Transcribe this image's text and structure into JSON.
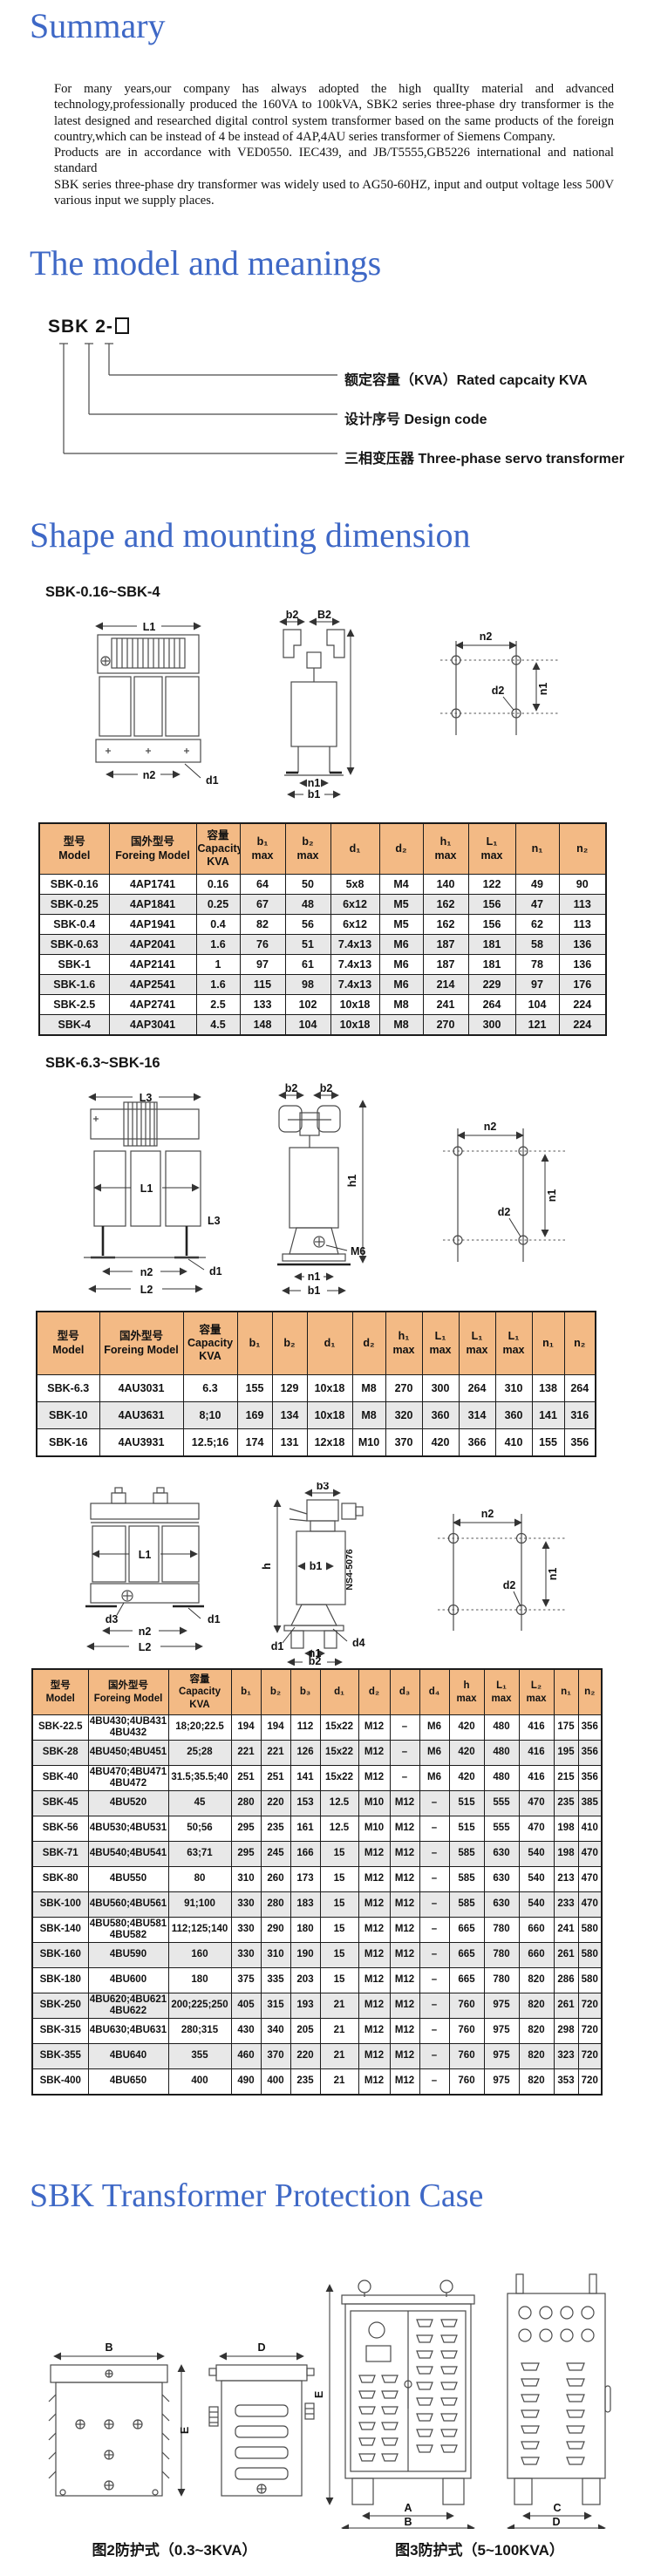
{
  "colors": {
    "heading_blue": "#3E68C6",
    "table_header_bg": "#F3BA85",
    "row_alt": "#E8E8E8"
  },
  "headings": {
    "summary": "Summary",
    "model": "The model and meanings",
    "shape": "Shape and mounting dimension",
    "protection": "SBK Transformer Protection Case"
  },
  "summary": {
    "p1": "For many years,our company has always adopted the high qualIty material and advanced technology,professionally produced the 160VA to 100kVA, SBK2 series three-phase dry transformer is the latest designed and researched digital control system transformer based on the same products of the foreign country,which can be instead of 4 be instead of 4AP,4AU series transformer of Siemens Company.",
    "p2": "Products are in accordance with VED0550. IEC439, and JB/T5555,GB5226 international and national standard",
    "p3": "SBK series three-phase dry transformer was widely used to AG50-60HZ, input and output voltage less 500V various input we supply places."
  },
  "model_diagram": {
    "code_prefix": "SBK",
    "code_mid": "2",
    "code_suffix": "-",
    "label_capacity": "额定容量（KVA）Rated capcaity KVA",
    "label_design": "设计序号 Design code",
    "label_phase": "三相变压器 Three-phase servo transformer"
  },
  "section1": {
    "label": "SBK-0.16~SBK-4",
    "header": [
      "型号\nModel",
      "国外型号\nForeing Model",
      "容量\nCapacity\nKVA",
      "b₁\nmax",
      "b₂\nmax",
      "d₁",
      "d₂",
      "h₁\nmax",
      "L₁\nmax",
      "n₁",
      "n₂"
    ],
    "rows": [
      [
        "SBK-0.16",
        "4AP1741",
        "0.16",
        "64",
        "50",
        "5x8",
        "M4",
        "140",
        "122",
        "49",
        "90"
      ],
      [
        "SBK-0.25",
        "4AP1841",
        "0.25",
        "67",
        "48",
        "6x12",
        "M5",
        "162",
        "156",
        "47",
        "113"
      ],
      [
        "SBK-0.4",
        "4AP1941",
        "0.4",
        "82",
        "56",
        "6x12",
        "M5",
        "162",
        "156",
        "62",
        "113"
      ],
      [
        "SBK-0.63",
        "4AP2041",
        "1.6",
        "76",
        "51",
        "7.4x13",
        "M6",
        "187",
        "181",
        "58",
        "136"
      ],
      [
        "SBK-1",
        "4AP2141",
        "1",
        "97",
        "61",
        "7.4x13",
        "M6",
        "187",
        "181",
        "78",
        "136"
      ],
      [
        "SBK-1.6",
        "4AP2541",
        "1.6",
        "115",
        "98",
        "7.4x13",
        "M6",
        "214",
        "229",
        "97",
        "176"
      ],
      [
        "SBK-2.5",
        "4AP2741",
        "2.5",
        "133",
        "102",
        "10x18",
        "M8",
        "241",
        "264",
        "104",
        "224"
      ],
      [
        "SBK-4",
        "4AP3041",
        "4.5",
        "148",
        "104",
        "10x18",
        "M8",
        "270",
        "300",
        "121",
        "224"
      ]
    ]
  },
  "section2": {
    "label": "SBK-6.3~SBK-16",
    "header": [
      "型号\nModel",
      "国外型号\nForeing Model",
      "容量\nCapacity\nKVA",
      "b₁",
      "b₂",
      "d₁",
      "d₂",
      "h₁\nmax",
      "L₁\nmax",
      "L₁\nmax",
      "L₁\nmax",
      "n₁",
      "n₂"
    ],
    "rows": [
      [
        "SBK-6.3",
        "4AU3031",
        "6.3",
        "155",
        "129",
        "10x18",
        "M8",
        "270",
        "300",
        "264",
        "310",
        "138",
        "264"
      ],
      [
        "SBK-10",
        "4AU3631",
        "8;10",
        "169",
        "134",
        "10x18",
        "M8",
        "320",
        "360",
        "314",
        "360",
        "141",
        "316"
      ],
      [
        "SBK-16",
        "4AU3931",
        "12.5;16",
        "174",
        "131",
        "12x18",
        "M10",
        "370",
        "420",
        "366",
        "410",
        "155",
        "356"
      ]
    ]
  },
  "section3": {
    "header": [
      "型号\nModel",
      "国外型号\nForeing Model",
      "容量\nCapacity\nKVA",
      "b₁",
      "b₂",
      "b₃",
      "d₁",
      "d₂",
      "d₃",
      "d₄",
      "h\nmax",
      "L₁\nmax",
      "L₂\nmax",
      "n₁",
      "n₂"
    ],
    "rows": [
      [
        "SBK-22.5",
        "4BU430;4UB431\n4BU432",
        "18;20;22.5",
        "194",
        "194",
        "112",
        "15x22",
        "M12",
        "–",
        "M6",
        "420",
        "480",
        "416",
        "175",
        "356"
      ],
      [
        "SBK-28",
        "4BU450;4BU451",
        "25;28",
        "221",
        "221",
        "126",
        "15x22",
        "M12",
        "–",
        "M6",
        "420",
        "480",
        "416",
        "195",
        "356"
      ],
      [
        "SBK-40",
        "4BU470;4BU471\n4BU472",
        "31.5;35.5;40",
        "251",
        "251",
        "141",
        "15x22",
        "M12",
        "–",
        "M6",
        "420",
        "480",
        "416",
        "215",
        "356"
      ],
      [
        "SBK-45",
        "4BU520",
        "45",
        "280",
        "220",
        "153",
        "12.5",
        "M10",
        "M12",
        "–",
        "515",
        "555",
        "470",
        "235",
        "385"
      ],
      [
        "SBK-56",
        "4BU530;4BU531",
        "50;56",
        "295",
        "235",
        "161",
        "12.5",
        "M10",
        "M12",
        "–",
        "515",
        "555",
        "470",
        "198",
        "410"
      ],
      [
        "SBK-71",
        "4BU540;4BU541",
        "63;71",
        "295",
        "245",
        "166",
        "15",
        "M12",
        "M12",
        "–",
        "585",
        "630",
        "540",
        "198",
        "470"
      ],
      [
        "SBK-80",
        "4BU550",
        "80",
        "310",
        "260",
        "173",
        "15",
        "M12",
        "M12",
        "–",
        "585",
        "630",
        "540",
        "213",
        "470"
      ],
      [
        "SBK-100",
        "4BU560;4BU561",
        "91;100",
        "330",
        "280",
        "183",
        "15",
        "M12",
        "M12",
        "–",
        "585",
        "630",
        "540",
        "233",
        "470"
      ],
      [
        "SBK-140",
        "4BU580;4BU581\n4BU582",
        "112;125;140",
        "330",
        "290",
        "180",
        "15",
        "M12",
        "M12",
        "–",
        "665",
        "780",
        "660",
        "241",
        "580"
      ],
      [
        "SBK-160",
        "4BU590",
        "160",
        "330",
        "310",
        "190",
        "15",
        "M12",
        "M12",
        "–",
        "665",
        "780",
        "660",
        "261",
        "580"
      ],
      [
        "SBK-180",
        "4BU600",
        "180",
        "375",
        "335",
        "203",
        "15",
        "M12",
        "M12",
        "–",
        "665",
        "780",
        "820",
        "286",
        "580"
      ],
      [
        "SBK-250",
        "4BU620;4BU621\n4BU622",
        "200;225;250",
        "405",
        "315",
        "193",
        "21",
        "M12",
        "M12",
        "–",
        "760",
        "975",
        "820",
        "261",
        "720"
      ],
      [
        "SBK-315",
        "4BU630;4BU631",
        "280;315",
        "430",
        "340",
        "205",
        "21",
        "M12",
        "M12",
        "–",
        "760",
        "975",
        "820",
        "298",
        "720"
      ],
      [
        "SBK-355",
        "4BU640",
        "355",
        "460",
        "370",
        "220",
        "21",
        "M12",
        "M12",
        "–",
        "760",
        "975",
        "820",
        "323",
        "720"
      ],
      [
        "SBK-400",
        "4BU650",
        "400",
        "490",
        "400",
        "235",
        "21",
        "M12",
        "M12",
        "–",
        "760",
        "975",
        "820",
        "353",
        "720"
      ]
    ]
  },
  "drawings": {
    "set1_front": {
      "dim_top": "L1",
      "dim_bottom": "n2",
      "hole": "d1"
    },
    "set1_side": {
      "dim1": "b2",
      "dim2": "B2",
      "dim_bottom1": "n1",
      "dim_bottom2": "b1"
    },
    "set1_holes": {
      "dim_top": "n2",
      "dim_side": "n1",
      "hole": "d2"
    },
    "set2_front": {
      "dim_top": "L3",
      "dim_mid": "L1",
      "label_right": "L3",
      "dim_bottom1": "n2",
      "dim_bottom2": "L2",
      "hole": "d1"
    },
    "set2_side": {
      "dim1": "b2",
      "dim2": "b2",
      "dim_height": "h1",
      "screw": "M6",
      "dim_bottom1": "n1",
      "dim_bottom2": "b1"
    },
    "set2_holes": {
      "dim_top": "n2",
      "dim_side": "n1",
      "hole": "d2"
    },
    "set3_front": {
      "dim_mid": "L1",
      "hole_left": "d3",
      "hole_right": "d1",
      "dim_bottom1": "n2",
      "dim_bottom2": "L2"
    },
    "set3_side": {
      "dim_top": "b3",
      "dim_height": "h",
      "dim_mid": "b1",
      "code": "NS4-5076",
      "hole_left": "d1",
      "dim_bottom": "n1",
      "hole_right": "d4",
      "dim_bottom2": "b2"
    },
    "set3_holes": {
      "dim_top": "n2",
      "dim_side": "n1",
      "hole": "d2"
    }
  },
  "protection": {
    "box1_width": "B",
    "box1_height": "E",
    "box2_width": "D",
    "cab_height": "E",
    "cab_inner": "A",
    "cab_width": "B",
    "cab2_inner": "C",
    "cab2_width": "D",
    "caption1": "图2防护式（0.3~3KVA）",
    "caption2": "图3防护式（5~100KVA）"
  }
}
